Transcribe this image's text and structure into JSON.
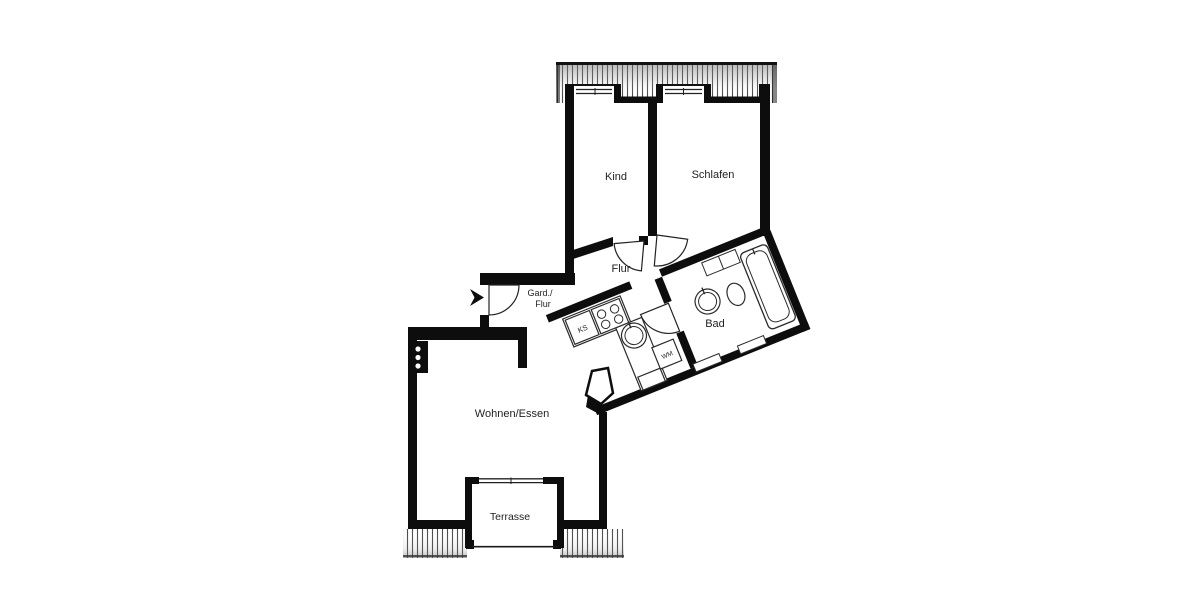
{
  "floorplan": {
    "background": "#ffffff",
    "wall_color": "#0d0d0d",
    "outline_color": "#2b2b2b",
    "rooms": {
      "kind": {
        "label": "Kind"
      },
      "schlafen": {
        "label": "Schlafen"
      },
      "flur": {
        "label": "Flur"
      },
      "garderobe": {
        "label_line1": "Gard./",
        "label_line2": "Flur"
      },
      "wohnen_essen": {
        "label": "Wohnen/Essen"
      },
      "bad": {
        "label": "Bad"
      },
      "terrasse": {
        "label": "Terrasse"
      }
    },
    "appliances": {
      "fridge_abbr": "KS",
      "washer_abbr": "WM"
    }
  }
}
